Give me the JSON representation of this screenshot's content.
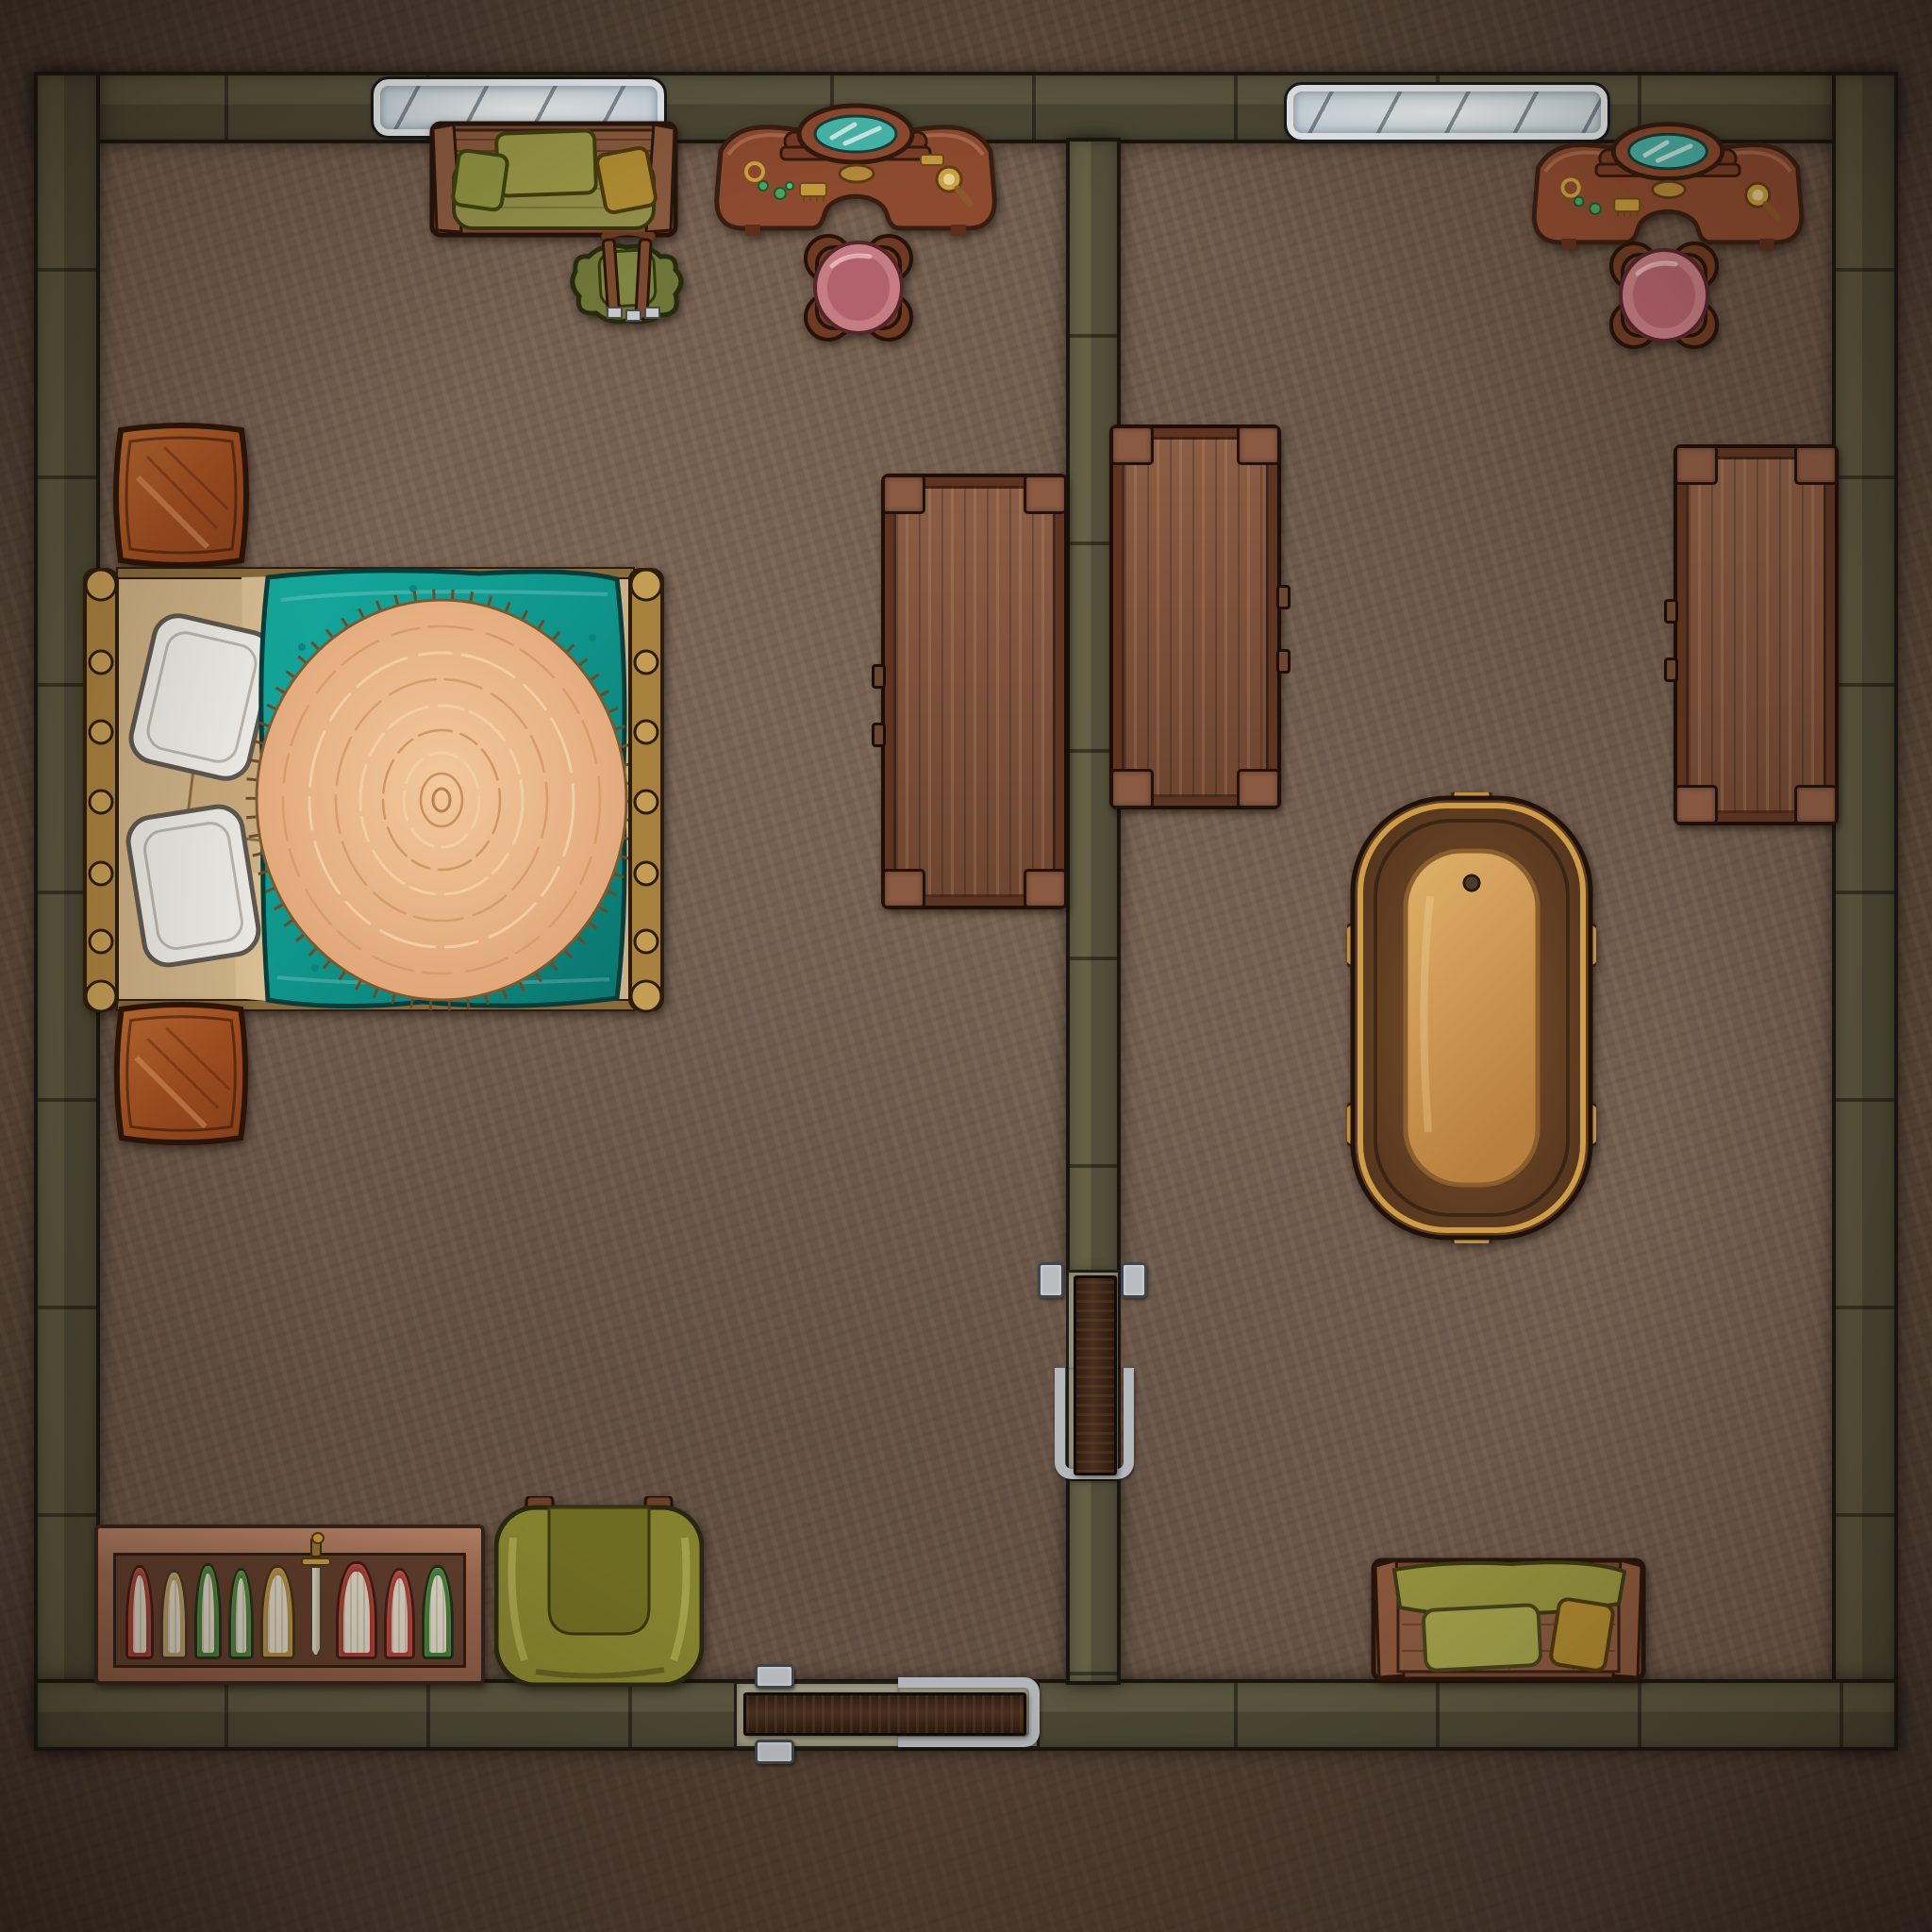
{
  "map": {
    "kind": "fantasy-interior-battlemap",
    "view": "top-down",
    "grid": "none",
    "rooms": [
      {
        "id": "bedroom",
        "label": "West room - bedroom"
      },
      {
        "id": "bath_chamber",
        "label": "East room - bath chamber"
      }
    ],
    "openings": {
      "windows": [
        {
          "label": "Window - north wall, west room"
        },
        {
          "label": "Window - north wall, east room"
        }
      ],
      "doors": [
        {
          "label": "Door - south wall of west room (dark wood, iron hinges)"
        },
        {
          "label": "Door - dividing wall between rooms (dark wood, iron hinges)"
        }
      ]
    },
    "furniture": [
      {
        "room": "bedroom",
        "type": "sofa",
        "label": "Green wooden sofa with three pillows"
      },
      {
        "room": "bedroom",
        "type": "backpack",
        "label": "Green traveler's backpack with straps and buckles"
      },
      {
        "room": "bedroom",
        "type": "vanity",
        "label": "Curved vanity table with teal mirror, jewelry and combs"
      },
      {
        "room": "bedroom",
        "type": "stool",
        "label": "Round stool with pink cushion"
      },
      {
        "room": "bedroom",
        "type": "chest",
        "label": "Orange wooden chest (north of bed)"
      },
      {
        "room": "bedroom",
        "type": "bed",
        "label": "Double bed, gold frame, teal blanket, round fur rug, white pillows"
      },
      {
        "room": "bedroom",
        "type": "chest",
        "label": "Orange wooden chest (south of bed)"
      },
      {
        "room": "bedroom",
        "type": "table",
        "label": "Long wooden table (west side of dividing wall)"
      },
      {
        "room": "bath_chamber",
        "type": "table",
        "label": "Long wooden table (east side of dividing wall)"
      },
      {
        "room": "bath_chamber",
        "type": "table",
        "label": "Long wooden table (by east wall)"
      },
      {
        "room": "bath_chamber",
        "type": "bathtub",
        "label": "Golden bronze bathtub"
      },
      {
        "room": "bedroom",
        "type": "bookshelf",
        "label": "Low bookshelf with books and a sword"
      },
      {
        "room": "bedroom",
        "type": "armchair",
        "label": "Olive green armchair"
      },
      {
        "room": "bath_chamber",
        "type": "bench",
        "label": "Wooden bench with green cushions"
      },
      {
        "room": "bath_chamber",
        "type": "vanity",
        "label": "Curved vanity table with teal mirror"
      },
      {
        "room": "bath_chamber",
        "type": "stool",
        "label": "Round stool with pink cushion"
      }
    ],
    "bookshelf": {
      "items": [
        {
          "kind": "book",
          "color": "#a23a31",
          "w": 36,
          "h": 100
        },
        {
          "kind": "book",
          "color": "#b59a62",
          "w": 34,
          "h": 95
        },
        {
          "kind": "book",
          "color": "#3f7c36",
          "w": 34,
          "h": 102
        },
        {
          "kind": "book",
          "color": "#46823a",
          "w": 32,
          "h": 97
        },
        {
          "kind": "book",
          "color": "#b08a3a",
          "w": 44,
          "h": 100
        },
        {
          "kind": "sword"
        },
        {
          "kind": "book",
          "color": "#a23a31",
          "w": 52,
          "h": 104
        },
        {
          "kind": "book",
          "color": "#a84038",
          "w": 40,
          "h": 97
        },
        {
          "kind": "book",
          "color": "#3f7c36",
          "w": 40,
          "h": 100
        }
      ]
    },
    "palette": {
      "floor_inside": "#6f5a4b",
      "floor_outside": "#5e4b3d",
      "wall_stone": "#8f8b76",
      "wall_outline": "#17150e",
      "wood_table": "#7d4e36",
      "wood_dark": "#4a2b1a",
      "gold_frame": "#c2974c",
      "teal_blanket": "#119a91",
      "fur_rug": "#e7ad80",
      "olive_green": "#8c8940",
      "mustard": "#b08c2e",
      "pink_cushion": "#c3767e",
      "orange_chest": "#ad5724",
      "mirror_teal": "#48b6aa",
      "window_glass": "#c7d8e1",
      "metal": "#b9bdc2"
    }
  }
}
